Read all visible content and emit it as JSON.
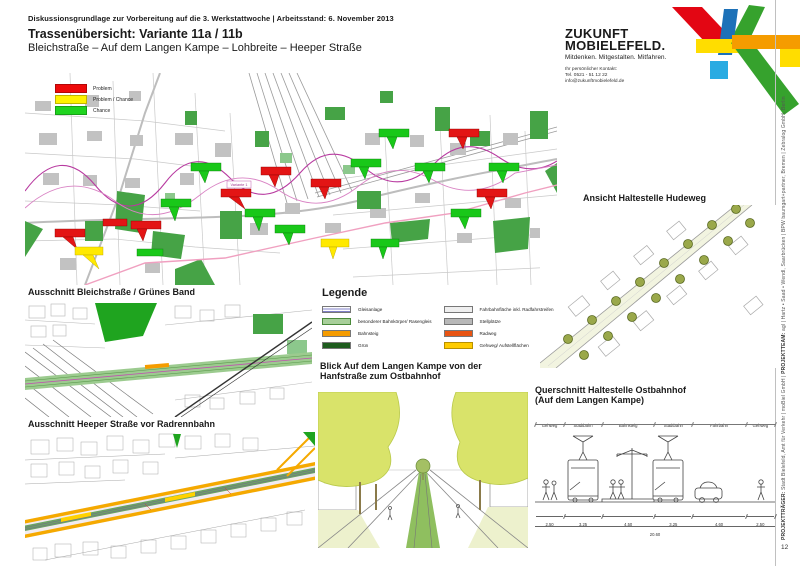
{
  "header": {
    "meta": "Diskussionsgrundlage zur Vorbereitung auf die 3. Werkstattwoche  |  Arbeitsstand: 6. November 2013",
    "title": "Trassenübersicht: Variante 11a / 11b",
    "subtitle": "Bleichstraße – Auf dem Langen Kampe – Lohbreite – Heeper Straße"
  },
  "brand": {
    "name_line1": "ZUKUNFT",
    "name_line2": "MOBIELEFELD.",
    "tagline": "Mitdenken. Mitgestalten. Mitfahren.",
    "contact_label": "Ihr persönlicher Kontakt:",
    "phone": "Tel. 0521 - 51 12 22",
    "email": "info@zukunftmobielefeld.de",
    "logo_colors": {
      "red": "#e30613",
      "blue": "#1d71b8",
      "cyan": "#29abe2",
      "yellow": "#ffdd00",
      "orange": "#f59c00",
      "green": "#36a22d"
    }
  },
  "map_overview": {
    "legend": [
      {
        "label": "Problem",
        "color": "#ee0a0a"
      },
      {
        "label": "Problem / Chance",
        "color": "#fff200"
      },
      {
        "label": "Chance",
        "color": "#1fd41f"
      }
    ],
    "tag_variante": "Variante 1"
  },
  "sections": {
    "bleichstrasse": "Ausschnitt Bleichstraße / Grünes Band",
    "heeper": "Ausschnitt Heeper Straße vor Radrennbahn",
    "hudeweg": "Ansicht Haltestelle Hudeweg",
    "blick_line1": "Blick Auf dem Langen Kampe von der",
    "blick_line2": "Hanfstraße zum Ostbahnhof",
    "querschnitt_line1": "Querschnitt Haltestelle Ostbahnhof",
    "querschnitt_line2": "(Auf dem Langen Kampe)"
  },
  "legende": {
    "title": "Legende",
    "left": [
      {
        "label": "Gleisanlage",
        "color": "#8080c8"
      },
      {
        "label": "besonderer Bahnkörper/ Rasengleis",
        "color": "#a8cf9a"
      },
      {
        "label": "Bahnsteig",
        "color": "#f59c00"
      },
      {
        "label": "Grün",
        "color": "#1e5c1e"
      }
    ],
    "right": [
      {
        "label": "Fahrbahnfläche inkl. Radfahrstreifen",
        "color": "#efefef"
      },
      {
        "label": "Stellplätze",
        "color": "#b8b8b8"
      },
      {
        "label": "Radweg",
        "color": "#e85413"
      },
      {
        "label": "Gehweg/ Aufstellflächen",
        "color": "#ffcc00"
      }
    ]
  },
  "cross_section": {
    "zones": [
      "Gehweg",
      "Stadtbahn",
      "Bahnsteig",
      "Stadtbahn",
      "Fahrbahn",
      "Gehweg"
    ],
    "dims": [
      "2.50",
      "3.25",
      "4.50",
      "3.25",
      "4.60",
      "2.50"
    ],
    "total": "20.60"
  },
  "sidebar": {
    "credits_role1": "PROJEKTTRÄGER:",
    "credits_text1": "Stadt Bielefeld, Amt für Verkehr | moBiel GmbH  |",
    "credits_role2": "PROJEKTTEAM:",
    "credits_text2": "agl | Hartz • Saad • Wendl, Saarbrücken | BPW baumgart+partner, Bremen | Zebralog GmbH, Berlin",
    "page_number": "12"
  }
}
